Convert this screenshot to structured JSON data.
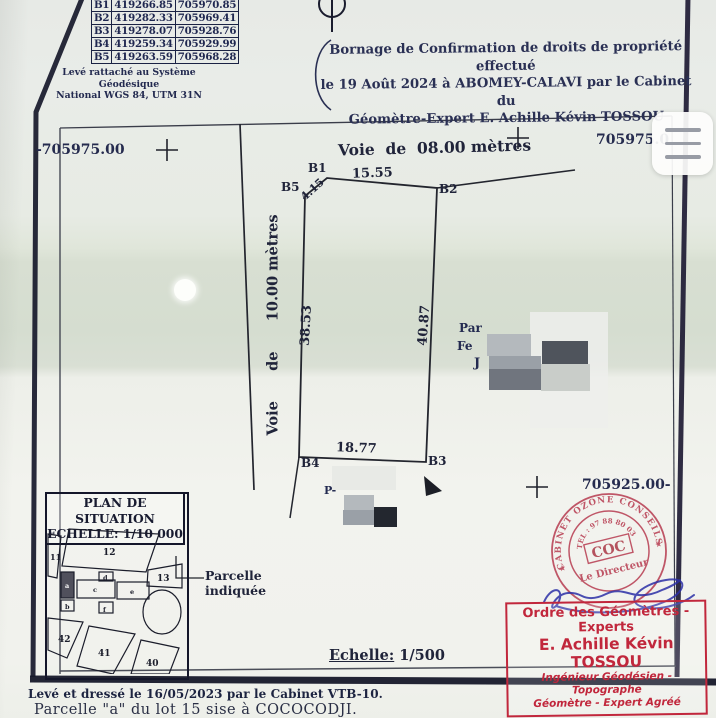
{
  "coordinates_table": {
    "rows": [
      [
        "B1",
        "419266.85",
        "705970.85"
      ],
      [
        "B2",
        "419282.33",
        "705969.41"
      ],
      [
        "B3",
        "419278.07",
        "705928.76"
      ],
      [
        "B4",
        "419259.34",
        "705929.99"
      ],
      [
        "B5",
        "419263.59",
        "705968.28"
      ]
    ],
    "note_line1": "Levé rattaché au Système Géodésique",
    "note_line2": "National WGS 84, UTM 31N"
  },
  "header": {
    "line1": "Bornage de Confirmation de droits de propriété effectué",
    "line2_prefix": "le ",
    "line2_bold": "19 Août 2024",
    "line2_suffix": " à ABOMEY-CALAVI par le Cabinet du",
    "line3_prefix": "Géomètre-Expert ",
    "line3_bold": "E. Achille Kévin TOSSOU"
  },
  "grid_labels": {
    "left_y": "-705975.00",
    "right_y_top": "705975.0",
    "right_y_bottom": "705925.00-"
  },
  "roads": {
    "top": "Voie  de  08.00 mètres",
    "left": "Voie      de      10.00 mètres"
  },
  "parcel": {
    "corners": [
      "B1",
      "B2",
      "B3",
      "B4",
      "B5"
    ],
    "dim_top": "15.55",
    "dim_cut": "4.15",
    "dim_left": "38.53",
    "dim_right": "40.87",
    "dim_bottom": "18.77",
    "redacted_fragment1": "Par",
    "redacted_fragment2": "Fe",
    "redacted_fragment3": "J",
    "redacted_fragment4": "P-"
  },
  "situation_plan": {
    "title": "PLAN DE SITUATION",
    "scale": "ECHELLE: 1/10 000",
    "lots": [
      "11",
      "12",
      "13",
      "40",
      "41",
      "42"
    ],
    "sub_lots": [
      "a",
      "b",
      "c",
      "d",
      "e",
      "f"
    ],
    "callout_line1": "Parcelle",
    "callout_line2": "indiquée"
  },
  "scale_note": {
    "label": "Echelle:",
    "value": " 1/500"
  },
  "stamp_round": {
    "ring_top": "CABINET OZONE CONSEILS",
    "ring_tel": "TEL : 97 88 80 03",
    "center": "COC",
    "subtitle": "Le Directeur",
    "star": "★"
  },
  "stamp_box": {
    "line1": "Ordre des Géomètres - Experts",
    "line2": "E. Achille Kévin TOSSOU",
    "line3": "Ingénieur Géodésien - Topographe",
    "line4": "Géomètre - Expert Agréé"
  },
  "footer": {
    "line1": "Levé et dressé le 16/05/2023 par le Cabinet VTB-10.",
    "line2": "Parcelle \"a\" du lot 15 sise à COCOCODJI."
  },
  "colors": {
    "ink": "#232a50",
    "line": "#23252e",
    "stamp_red": "#b5344a",
    "signature_blue": "#2b2fa6"
  }
}
